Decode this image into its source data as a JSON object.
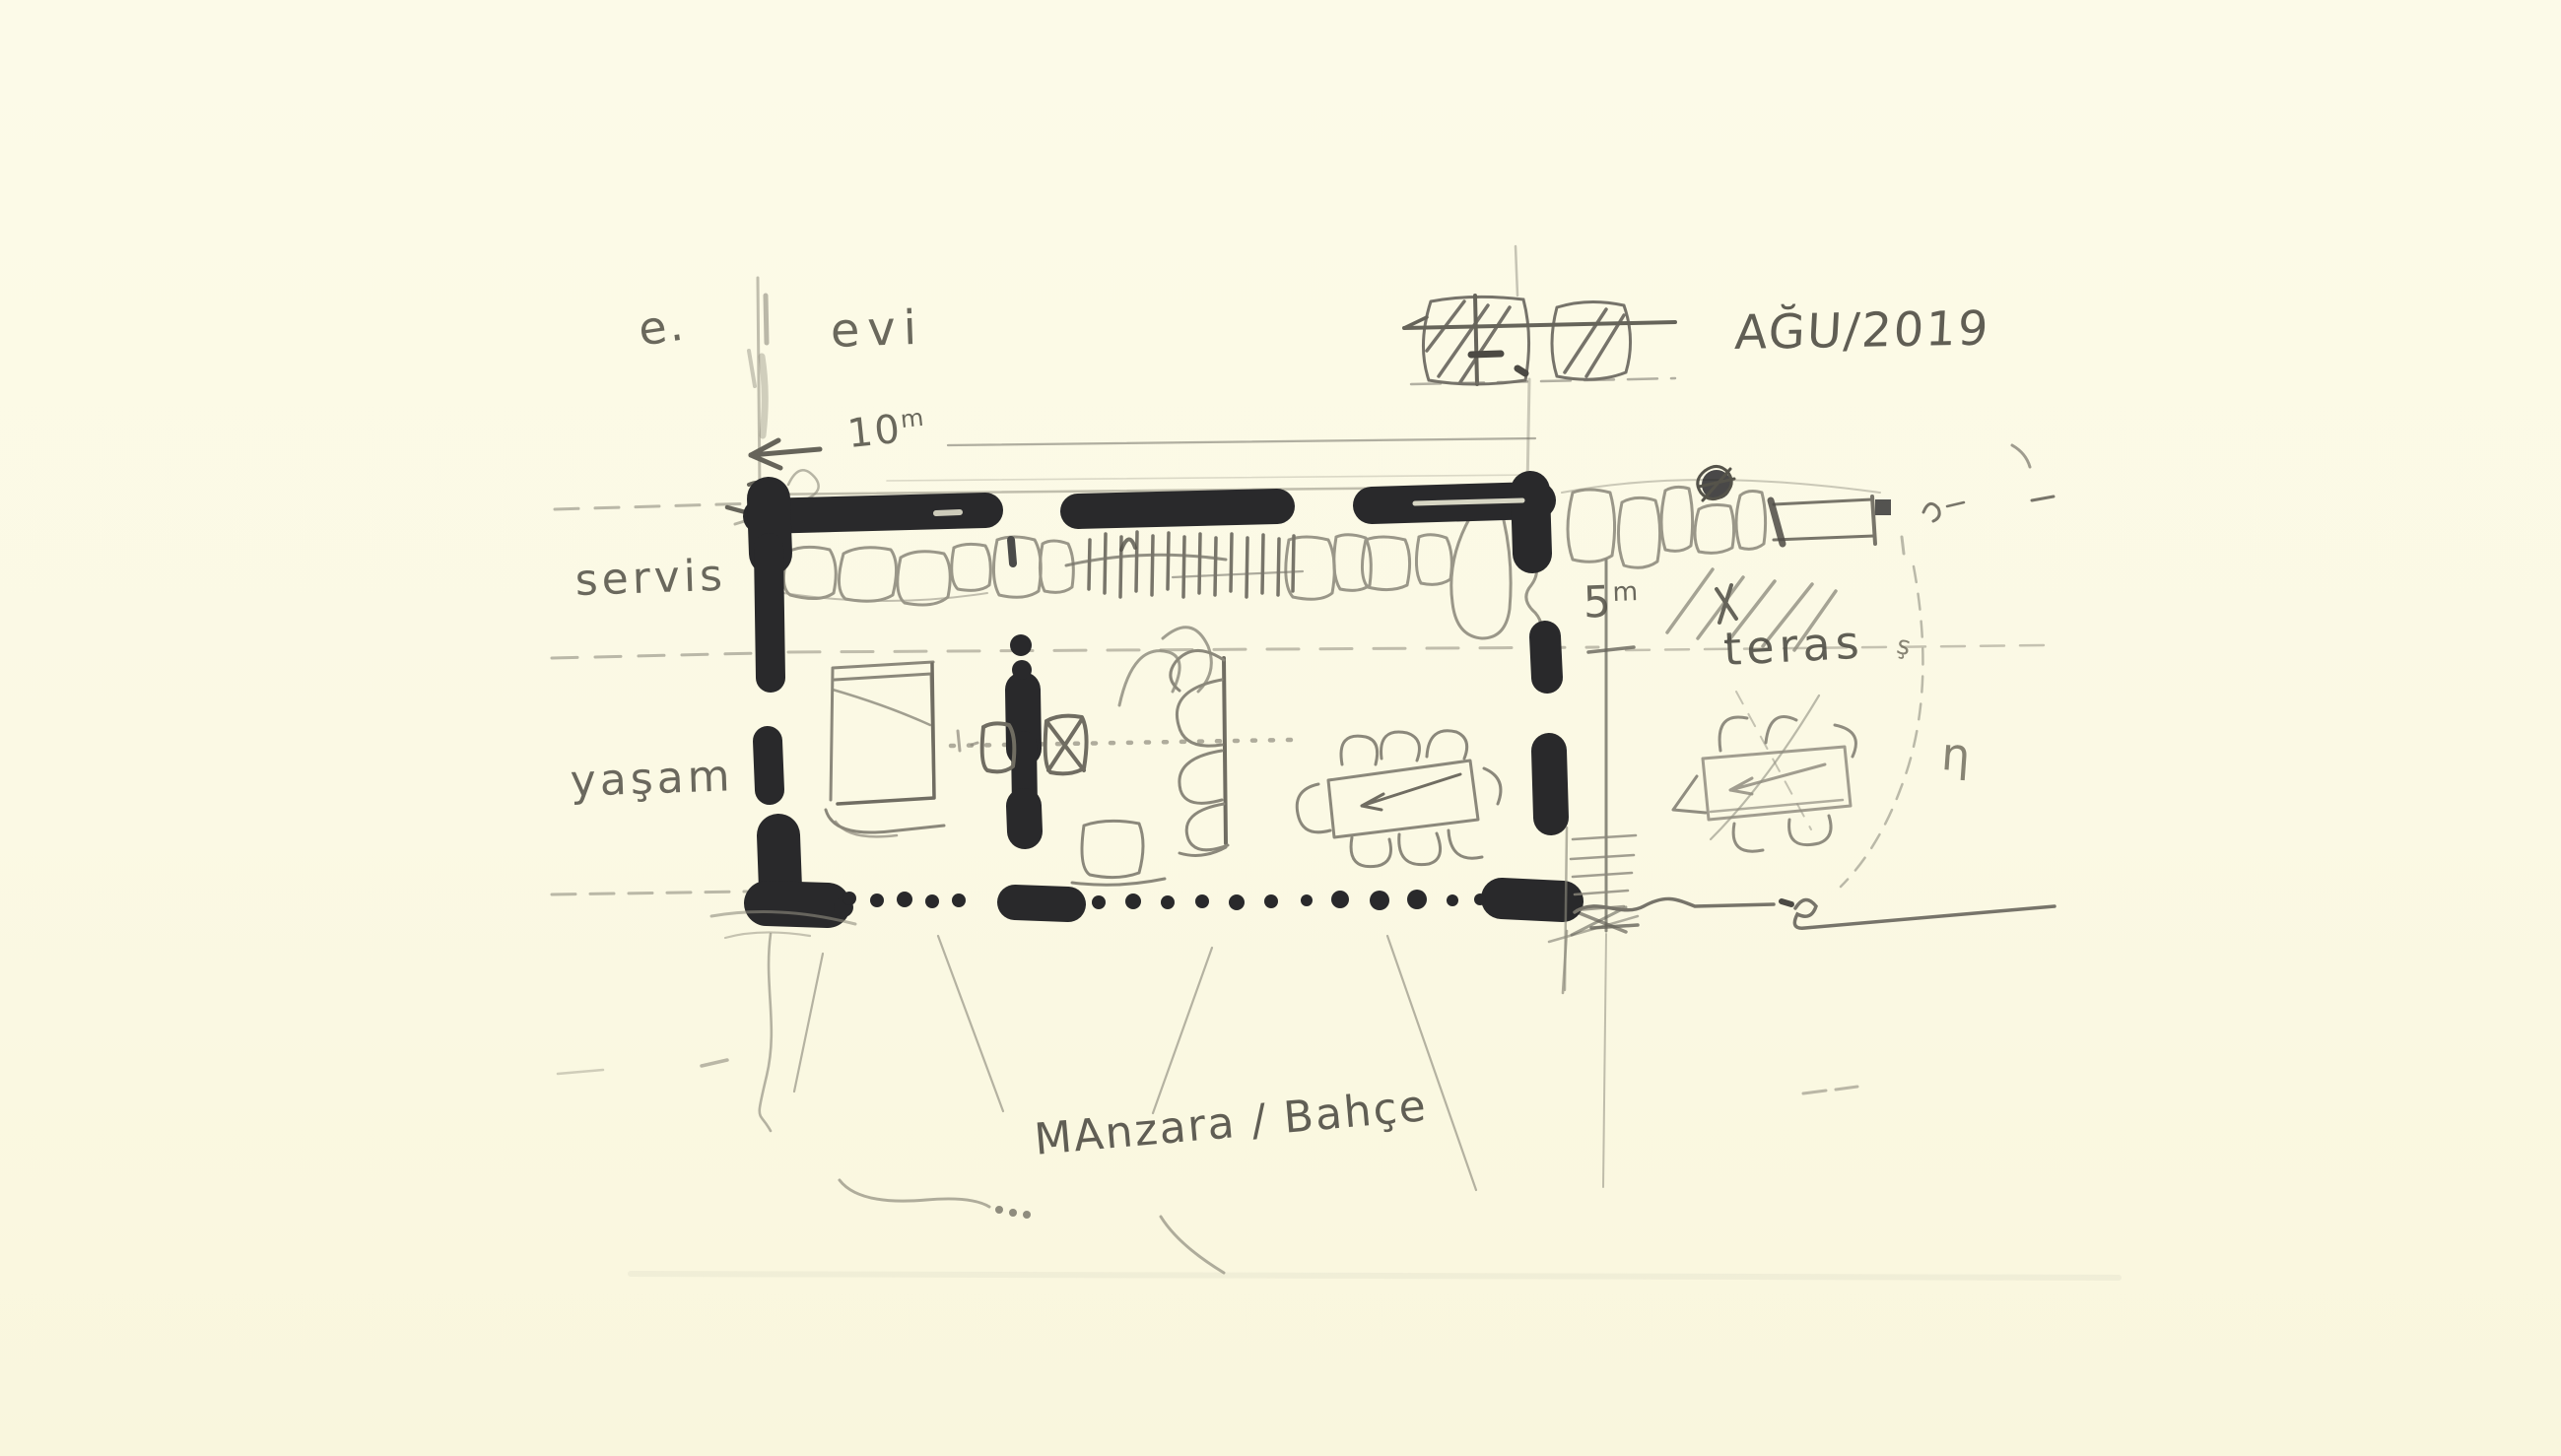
{
  "sketch": {
    "header": {
      "letter": "e.",
      "word": "evi",
      "date": "AĞU/2019"
    },
    "dimensions": {
      "width_value": "10",
      "width_unit": "m",
      "depth_value": "5",
      "depth_unit": "m"
    },
    "rooms": {
      "servis": "servis",
      "yasam": "yaşam",
      "teras": "teras"
    },
    "view_label": "MAnzara / Bahçe",
    "margin_marks": {
      "right_letter": "η",
      "right_small": "ş"
    }
  },
  "palette": {
    "paper": "#fbf9e4",
    "pencil_light": "#9a978a",
    "pencil_mid": "#7d7a6e",
    "pencil_dark": "#55534a",
    "marker": "#29292b"
  }
}
